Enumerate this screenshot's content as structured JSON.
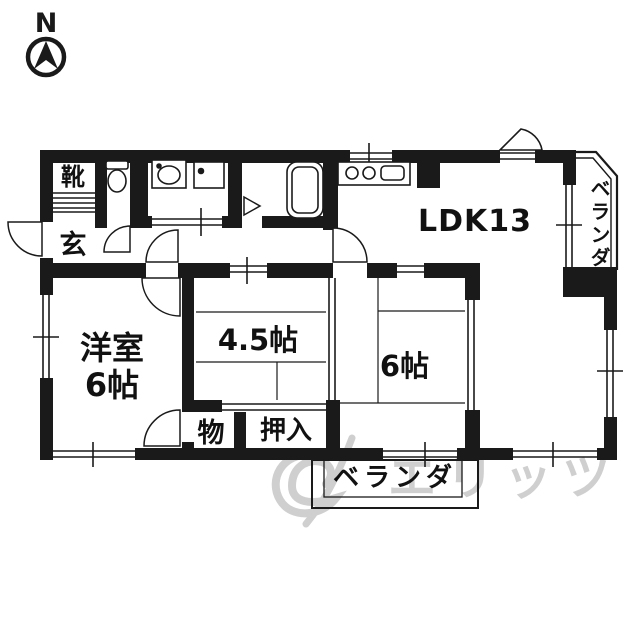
{
  "compass": {
    "label": "N"
  },
  "rooms": {
    "ldk": {
      "label": "LDK13"
    },
    "western": {
      "label": "洋室\n6帖"
    },
    "tatami45": {
      "label": "4.5帖"
    },
    "tatami6": {
      "label": "6帖"
    },
    "entrance": {
      "label": "玄"
    },
    "shoe_cabinet": {
      "label": "靴"
    },
    "storage": {
      "label": "物"
    },
    "closet": {
      "label": "押入"
    },
    "veranda_right": {
      "label": "ベランダ"
    },
    "veranda_bottom": {
      "label": "ベランダ"
    }
  },
  "watermark": {
    "text": "エリッツ"
  },
  "colors": {
    "wall": "#1a1a1a",
    "watermark": "#a8a8a8"
  }
}
